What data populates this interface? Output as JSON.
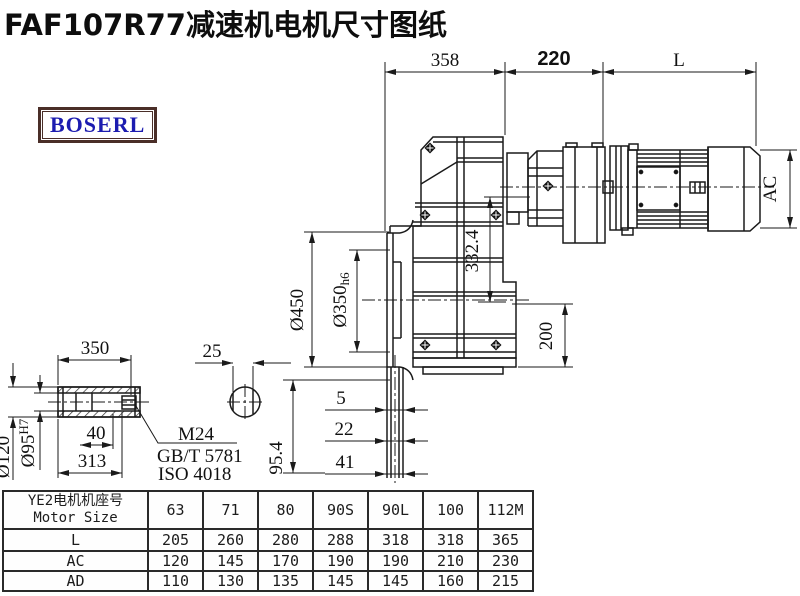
{
  "title": "FAF107R77减速机电机尺寸图纸",
  "logo": {
    "text": "BOSERL"
  },
  "drawing": {
    "dims": {
      "d358": "358",
      "d220": "220",
      "dL": "L",
      "dAC": "AC",
      "d450": "Ø450",
      "d350": "Ø350",
      "d350_tol": "h6",
      "d3324": "332.4",
      "d200": "200",
      "d954": "95.4",
      "d5": "5",
      "d22": "22",
      "d41": "41"
    },
    "shaft": {
      "len": "350",
      "key": "25",
      "d40": "40",
      "d313": "313",
      "od": "Ø120",
      "bore": "Ø95",
      "bore_tol": "H7",
      "thread": "M24",
      "std1": "GB/T 5781",
      "std2": "ISO 4018"
    }
  },
  "table": {
    "header_cn": "YE2电机机座号",
    "header_en": "Motor Size",
    "columns": [
      "63",
      "71",
      "80",
      "90S",
      "90L",
      "100",
      "112M"
    ],
    "rows": [
      {
        "label": "L",
        "values": [
          "205",
          "260",
          "280",
          "288",
          "318",
          "318",
          "365"
        ]
      },
      {
        "label": "AC",
        "values": [
          "120",
          "145",
          "170",
          "190",
          "190",
          "210",
          "230"
        ]
      },
      {
        "label": "AD",
        "values": [
          "110",
          "130",
          "135",
          "145",
          "145",
          "160",
          "215"
        ]
      }
    ]
  }
}
